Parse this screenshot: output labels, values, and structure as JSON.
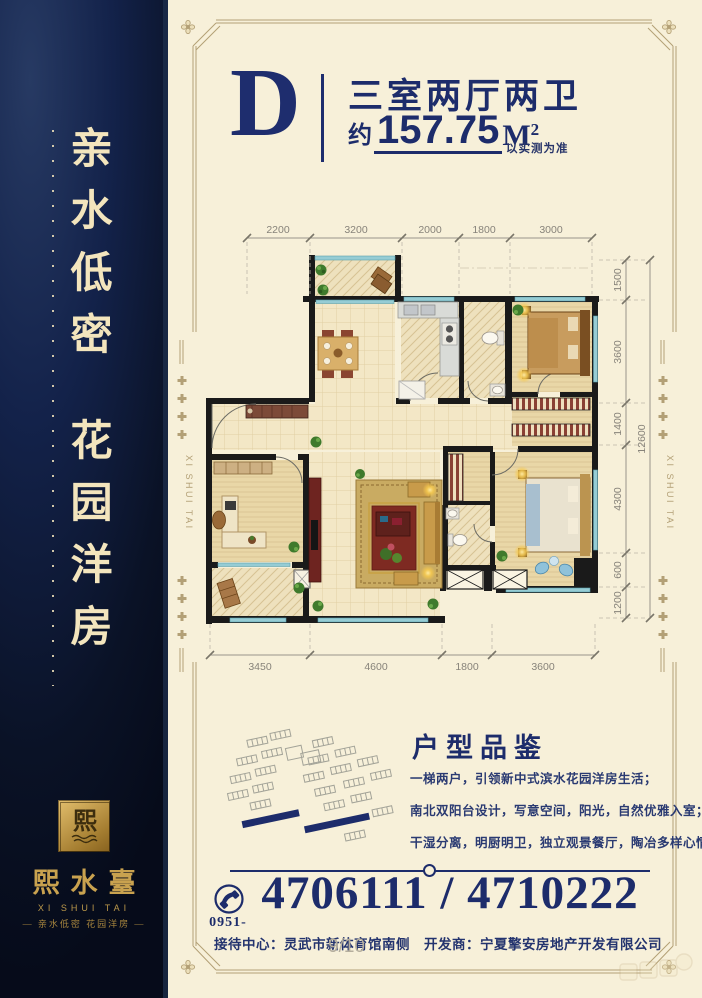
{
  "page": {
    "number": "9/10"
  },
  "sidebar": {
    "slogan1": "亲水低密",
    "slogan2": "花园洋房",
    "logo": {
      "mark": "熙",
      "name": "熙水臺",
      "name_en": "XI SHUI TAI",
      "tagline": "— 亲水低密 花园洋房 —"
    }
  },
  "header": {
    "unit": "D",
    "layout": "三室两厅两卫",
    "area_prefix": "约",
    "area_value": "157.75",
    "area_unit": "M",
    "area_sup": "2",
    "area_note": "以实测为准"
  },
  "floor_plan": {
    "dims_top": [
      "2200",
      "3200",
      "2000",
      "1800",
      "3000"
    ],
    "dims_bottom": [
      "3450",
      "4600",
      "1800",
      "3600"
    ],
    "dims_right": [
      "1500",
      "3600",
      "1400",
      "4300",
      "600",
      "1200"
    ],
    "dims_right_total": "12600",
    "frame_side_label": "XI SHUI TAI"
  },
  "features": {
    "title": "户型品鉴",
    "lines": [
      "一梯两户，引领新中式滨水花园洋房生活；",
      "南北双阳台设计，写意空间，阳光，自然优雅入室；",
      "干湿分离，明厨明卫，独立观景餐厅，陶冶多样心情"
    ]
  },
  "contact": {
    "area_code": "0951-",
    "phones": "4706111 / 4710222",
    "address": "接待中心：灵武市新体育馆南侧　开发商：宁夏擎安房地产开发有限公司"
  }
}
